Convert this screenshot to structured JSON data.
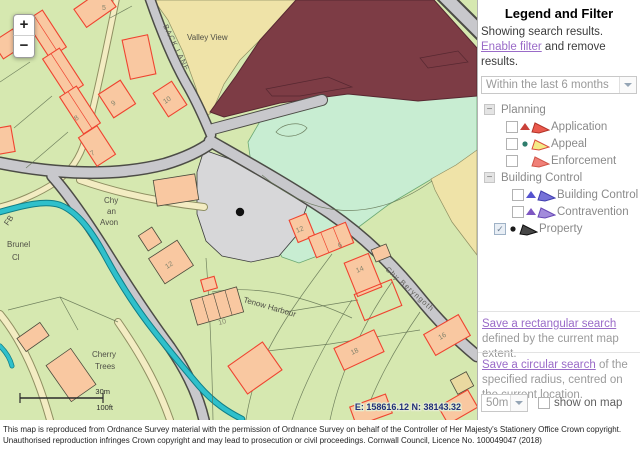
{
  "map": {
    "controls": {
      "zoom_in": "+",
      "zoom_out": "−"
    },
    "scale_bar": {
      "metric": "30m",
      "imperial": "100ft"
    },
    "coordinates": "E: 158616.12 N: 38143.32",
    "labels": [
      {
        "t": "Valley View",
        "x": 187,
        "y": 40
      },
      {
        "t": "BACK LANE",
        "x": 163,
        "y": 26,
        "r": 64,
        "c": "road"
      },
      {
        "t": "Chy",
        "x": 104,
        "y": 203
      },
      {
        "t": "an",
        "x": 107,
        "y": 214
      },
      {
        "t": "Avon",
        "x": 100,
        "y": 225
      },
      {
        "t": "Brunel",
        "x": 7,
        "y": 247
      },
      {
        "t": "Cl",
        "x": 12,
        "y": 260
      },
      {
        "t": "FB",
        "x": 8,
        "y": 226,
        "r": -55
      },
      {
        "t": "Chy Beryngoth",
        "x": 385,
        "y": 270,
        "r": 42,
        "c": "road"
      },
      {
        "t": "Tenow Harbour",
        "x": 243,
        "y": 302,
        "r": 16
      },
      {
        "t": "Cherry",
        "x": 92,
        "y": 357
      },
      {
        "t": "Trees",
        "x": 95,
        "y": 369
      },
      {
        "t": "5",
        "x": 102,
        "y": 10,
        "c": "num"
      },
      {
        "t": "9",
        "x": 113,
        "y": 106,
        "r": -33,
        "c": "num"
      },
      {
        "t": "8",
        "x": 76,
        "y": 121,
        "r": -33,
        "c": "num"
      },
      {
        "t": "7",
        "x": 92,
        "y": 156,
        "r": -33,
        "c": "num"
      },
      {
        "t": "10",
        "x": 165,
        "y": 104,
        "r": -33,
        "c": "num"
      },
      {
        "t": "12",
        "x": 167,
        "y": 269,
        "r": -33,
        "c": "num"
      },
      {
        "t": "12",
        "x": 297,
        "y": 233,
        "r": -22,
        "c": "num"
      },
      {
        "t": "6",
        "x": 339,
        "y": 248,
        "r": -22,
        "c": "num"
      },
      {
        "t": "14",
        "x": 357,
        "y": 273,
        "r": -22,
        "c": "num"
      },
      {
        "t": "10",
        "x": 219,
        "y": 325,
        "r": -15,
        "c": "num"
      },
      {
        "t": "16",
        "x": 440,
        "y": 340,
        "r": -30,
        "c": "num"
      },
      {
        "t": "18",
        "x": 352,
        "y": 355,
        "r": -25,
        "c": "num"
      }
    ],
    "buildings": [
      {
        "cx": 95,
        "cy": 8,
        "w": 36,
        "h": 22,
        "r": -35,
        "o": "red"
      },
      {
        "cx": 46,
        "cy": 34,
        "w": 20,
        "h": 44,
        "r": -33,
        "o": "red",
        "divs": 2
      },
      {
        "cx": 63,
        "cy": 72,
        "w": 20,
        "h": 44,
        "r": -33,
        "o": "red",
        "divs": 2
      },
      {
        "cx": 80,
        "cy": 110,
        "w": 20,
        "h": 44,
        "r": -33,
        "o": "red",
        "divs": 2
      },
      {
        "cx": 97,
        "cy": 146,
        "w": 22,
        "h": 34,
        "r": -33,
        "o": "red"
      },
      {
        "cx": 117,
        "cy": 99,
        "w": 26,
        "h": 28,
        "r": -33,
        "o": "red"
      },
      {
        "cx": 8,
        "cy": 44,
        "w": 24,
        "h": 20,
        "r": -33,
        "o": "red"
      },
      {
        "cx": 5,
        "cy": 140,
        "w": 16,
        "h": 26,
        "r": -10,
        "o": "red"
      },
      {
        "cx": 139,
        "cy": 57,
        "w": 26,
        "h": 40,
        "r": -12,
        "o": "red"
      },
      {
        "cx": 170,
        "cy": 99,
        "w": 22,
        "h": 28,
        "r": -33,
        "o": "red"
      },
      {
        "cx": 176,
        "cy": 190,
        "w": 42,
        "h": 26,
        "r": -9,
        "o": "dark"
      },
      {
        "cx": 150,
        "cy": 239,
        "w": 16,
        "h": 18,
        "r": -33,
        "o": "dark"
      },
      {
        "cx": 171,
        "cy": 262,
        "w": 34,
        "h": 30,
        "r": -33,
        "o": "dark"
      },
      {
        "cx": 302,
        "cy": 228,
        "w": 18,
        "h": 24,
        "r": -22,
        "o": "red"
      },
      {
        "cx": 331,
        "cy": 240,
        "w": 40,
        "h": 22,
        "r": -22,
        "o": "red",
        "divs": 3
      },
      {
        "cx": 363,
        "cy": 275,
        "w": 26,
        "h": 36,
        "r": -22,
        "o": "red"
      },
      {
        "cx": 381,
        "cy": 253,
        "w": 16,
        "h": 13,
        "r": -22,
        "o": "dark"
      },
      {
        "cx": 378,
        "cy": 300,
        "w": 40,
        "h": 28,
        "r": -22,
        "o": "redOnly"
      },
      {
        "cx": 447,
        "cy": 335,
        "w": 40,
        "h": 24,
        "r": -30,
        "o": "red"
      },
      {
        "cx": 359,
        "cy": 350,
        "w": 44,
        "h": 24,
        "r": -25,
        "o": "red"
      },
      {
        "cx": 217,
        "cy": 306,
        "w": 48,
        "h": 26,
        "r": -16,
        "o": "dark",
        "divs": 4
      },
      {
        "cx": 209,
        "cy": 284,
        "w": 14,
        "h": 12,
        "r": -16,
        "o": "red"
      },
      {
        "cx": 255,
        "cy": 368,
        "w": 42,
        "h": 34,
        "r": -35,
        "o": "red"
      },
      {
        "cx": 71,
        "cy": 375,
        "w": 30,
        "h": 44,
        "r": -35,
        "o": "dark"
      },
      {
        "cx": 33,
        "cy": 337,
        "w": 28,
        "h": 16,
        "r": -35,
        "o": "dark"
      },
      {
        "cx": 462,
        "cy": 383,
        "w": 18,
        "h": 16,
        "r": -28,
        "o": "tan"
      },
      {
        "cx": 371,
        "cy": 410,
        "w": 38,
        "h": 20,
        "r": -20,
        "o": "red"
      },
      {
        "cx": 458,
        "cy": 407,
        "w": 34,
        "h": 20,
        "r": -30,
        "o": "red"
      }
    ]
  },
  "panel": {
    "title": "Legend and Filter",
    "intro": {
      "pre": "Showing search results. ",
      "link": "Enable filter",
      "post": " and remove results."
    },
    "filter_select": {
      "value": "Within the last 6 months"
    },
    "legend_groups": [
      {
        "label": "Planning",
        "collapse_glyph": "−",
        "items": [
          {
            "label": "Application",
            "indent": 28,
            "checked": false,
            "marker": "triangle",
            "marker_color": "#c9413a",
            "flag_fill": "#ea5a4e",
            "flag_stroke": "#b23328"
          },
          {
            "label": "Appeal",
            "indent": 28,
            "checked": false,
            "marker": "dot",
            "marker_color": "#2f7d6d",
            "flag_fill": "#f4ea86",
            "flag_stroke": "#d94a3c"
          },
          {
            "label": "Enforcement",
            "indent": 28,
            "checked": false,
            "marker": "none",
            "marker_color": "",
            "flag_fill": "#f08078",
            "flag_stroke": "#d05548"
          }
        ]
      },
      {
        "label": "Building Control",
        "collapse_glyph": "−",
        "items": [
          {
            "label": "Building Control",
            "indent": 34,
            "checked": false,
            "marker": "triangle",
            "marker_color": "#5553cf",
            "flag_fill": "#7672d8",
            "flag_stroke": "#403dae"
          },
          {
            "label": "Contravention",
            "indent": 34,
            "checked": false,
            "marker": "triangle",
            "marker_color": "#7e57c2",
            "flag_fill": "#a28bdb",
            "flag_stroke": "#6748b5"
          },
          {
            "label": "Property",
            "indent": 16,
            "checked": true,
            "marker": "dot",
            "marker_color": "#1a1a1a",
            "flag_fill": "#474747",
            "flag_stroke": "#0d0d0d"
          }
        ]
      }
    ],
    "rect_search": {
      "link": "Save a rectangular search",
      "rest": " defined by the current map extent."
    },
    "circ_search": {
      "link": "Save a circular search",
      "rest": " of the specified radius, centred on the current location."
    },
    "radius_select": {
      "value": "50m"
    },
    "show_on_map_label": "show on map"
  },
  "footer": {
    "text": "This map is reproduced from Ordnance Survey material with the permission of Ordnance Survey on behalf of the Controller of Her Majesty's Stationery Office Crown copyright. Unauthorised reproduction infringes Crown copyright and may lead to prosecution or civil proceedings. Cornwall Council, Licence No. 100049047 (2018)"
  }
}
